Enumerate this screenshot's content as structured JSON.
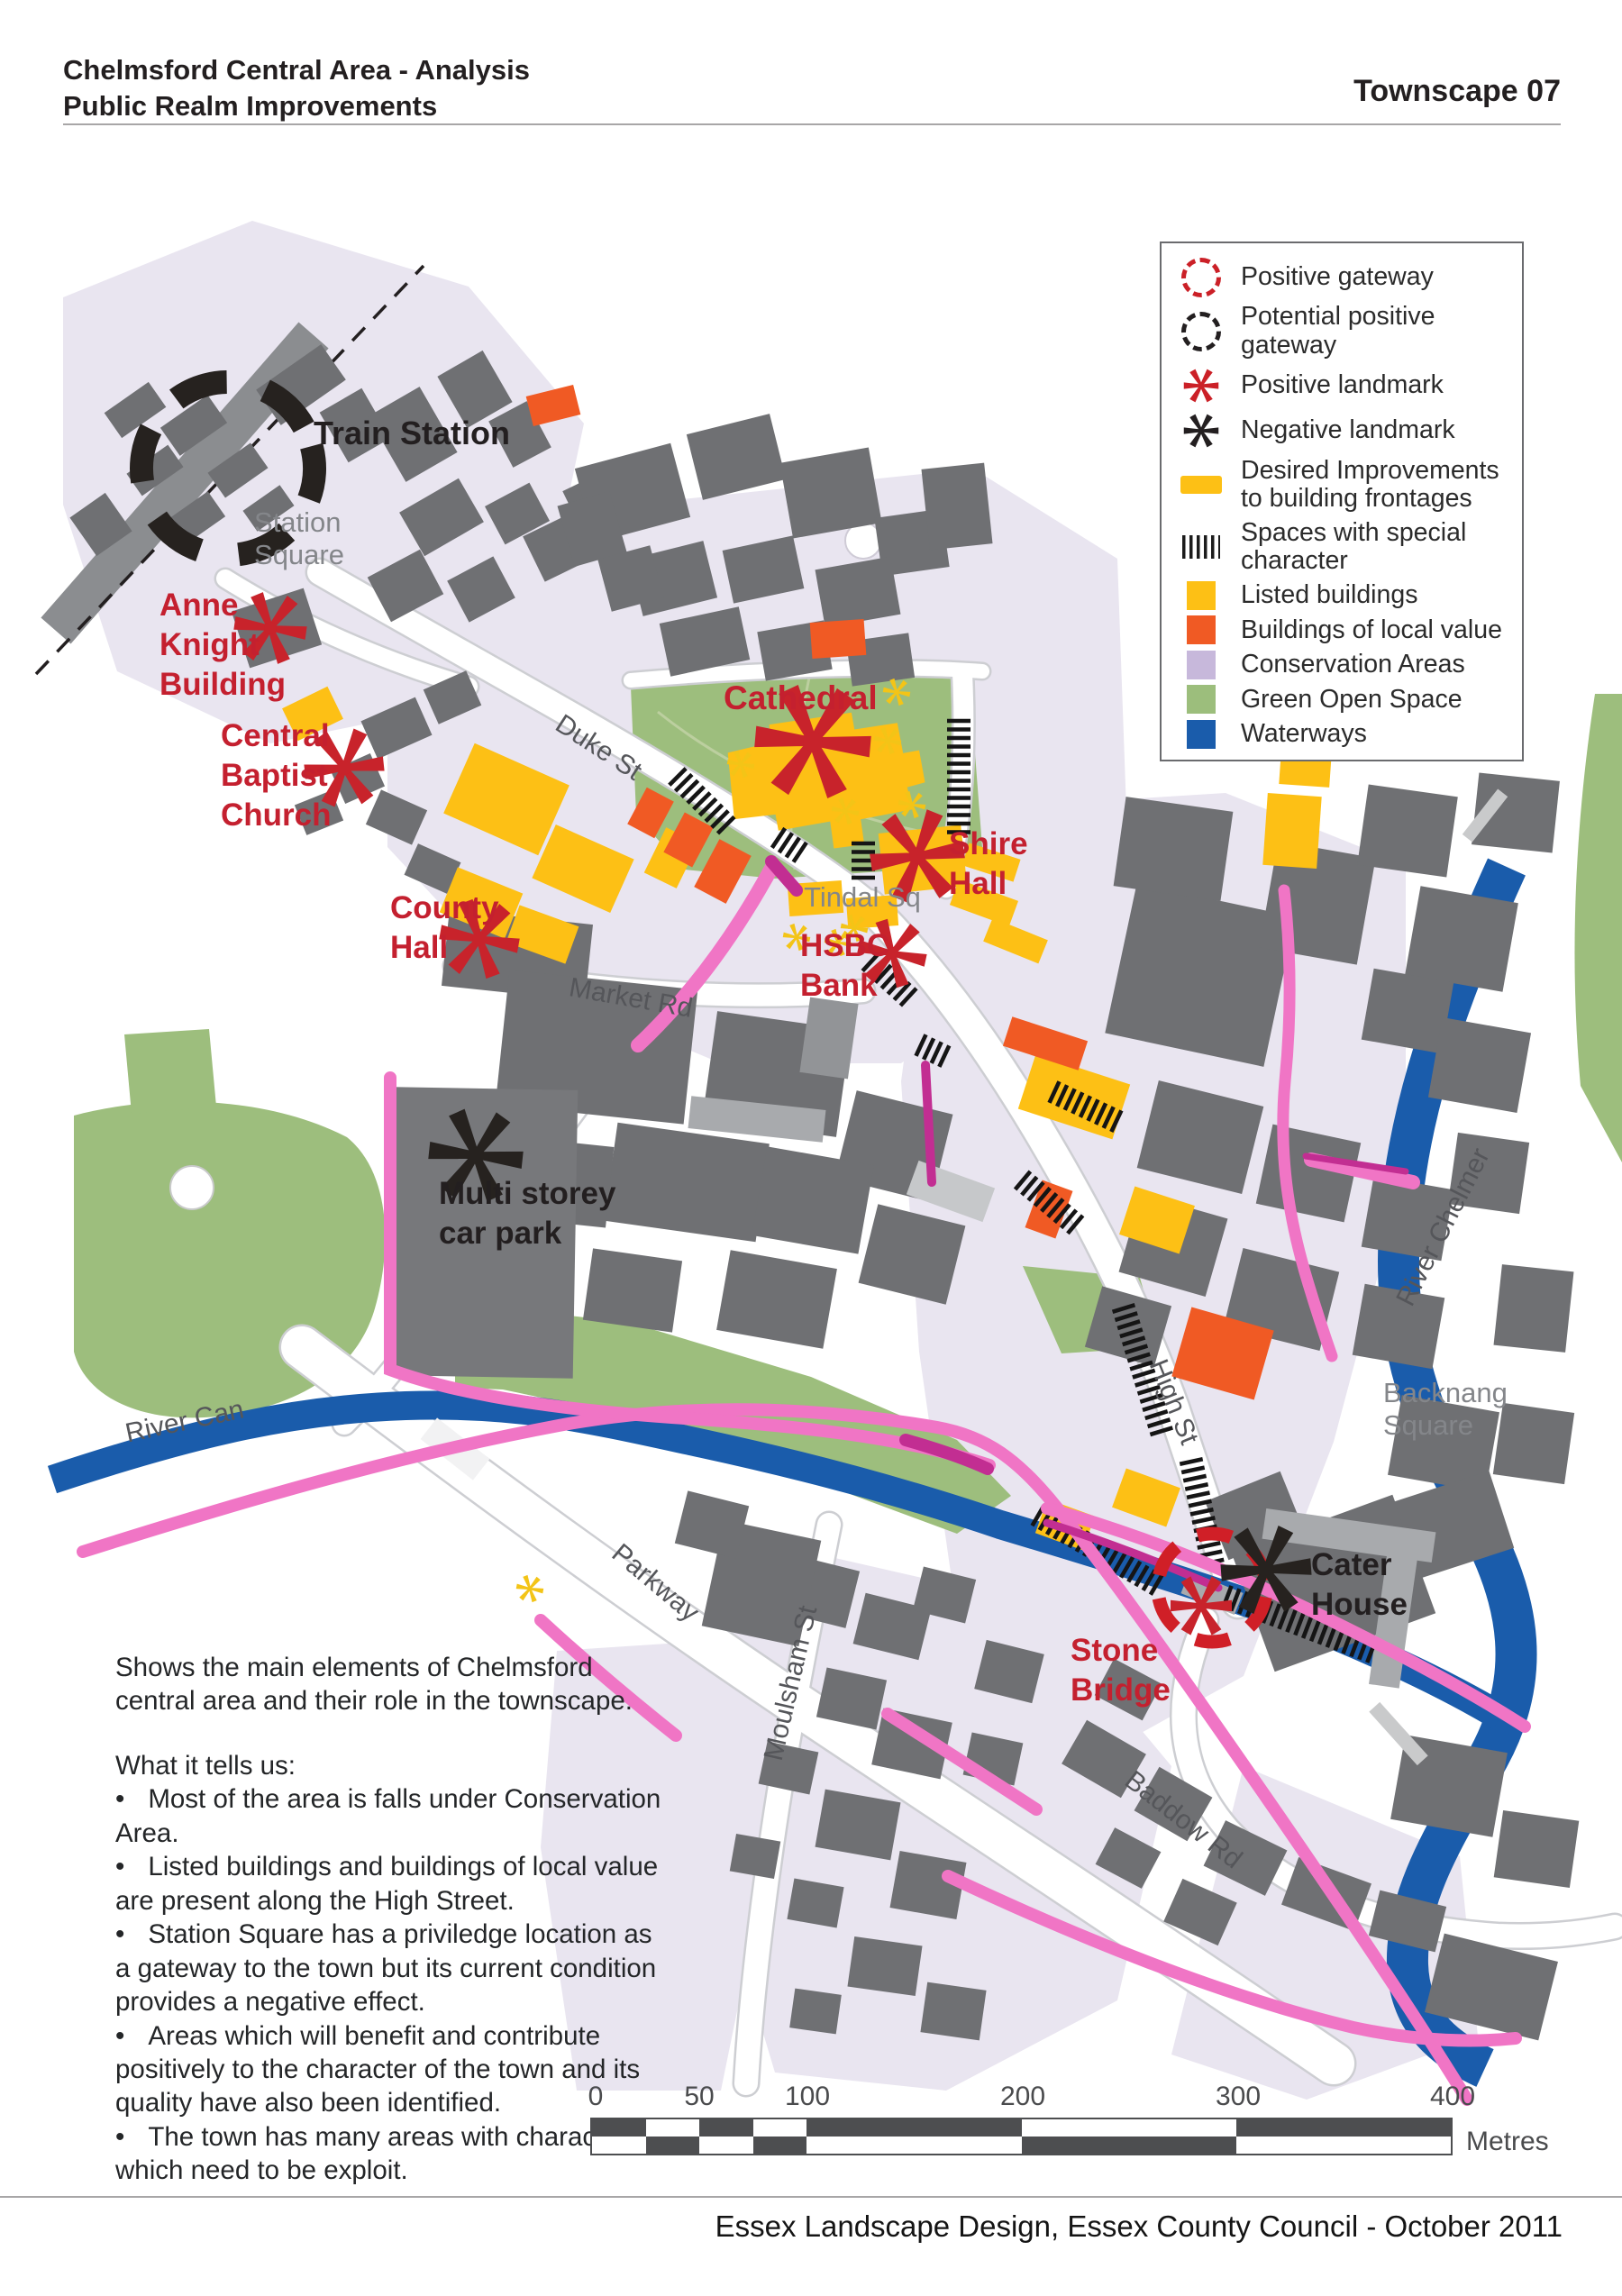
{
  "header": {
    "title_line1": "Chelmsford Central Area - Analysis",
    "title_line2": "Public Realm Improvements",
    "page_label": "Townscape",
    "page_number": "07"
  },
  "footer": {
    "credit": "Essex Landscape Design, Essex County Council - October 2011"
  },
  "legend": {
    "items": [
      {
        "id": "positive-gateway",
        "label": "Positive gateway",
        "color": "#CB2027"
      },
      {
        "id": "potential-positive-gateway",
        "label": "Potential positive gateway",
        "color": "#231F20"
      },
      {
        "id": "positive-landmark",
        "label": "Positive landmark",
        "color": "#CB2027"
      },
      {
        "id": "negative-landmark",
        "label": "Negative landmark",
        "color": "#231F20"
      },
      {
        "id": "desired-improvements",
        "label": "Desired Improvements to building frontages",
        "color": "#FDC015"
      },
      {
        "id": "special-character",
        "label": "Spaces with special character",
        "color": "#1C1C1C"
      },
      {
        "id": "listed-buildings",
        "label": "Listed buildings",
        "color": "#FDC015"
      },
      {
        "id": "local-value",
        "label": "Buildings of local value",
        "color": "#F05A24"
      },
      {
        "id": "conservation-areas",
        "label": "Conservation Areas",
        "color": "#C7B8DB"
      },
      {
        "id": "green-open-space",
        "label": "Green Open Space",
        "color": "#9CBE7C"
      },
      {
        "id": "waterways",
        "label": "Waterways",
        "color": "#1A5CAB"
      }
    ]
  },
  "map_labels": {
    "train_station": "Train Station",
    "station_square": "Station\nSquare",
    "anne_knight": "Anne\nKnight\nBuilding",
    "central_baptist": "Central\nBaptist\nChurch",
    "county_hall": "County\nHall",
    "cathedral": "Cathedral",
    "shire_hall": "Shire\nHall",
    "hsbc": "HSBC\nBank",
    "tindal_sq": "Tindal Sq",
    "multi_storey": "Multi storey\ncar park",
    "cater_house": "Cater\nHouse",
    "stone_bridge": "Stone\nBridge",
    "backnang": "Backnang\nSquare",
    "river_chelmer": "River Chelmer",
    "river_can": "River Can",
    "high_st": "High St",
    "duke_st": "Duke St",
    "market_rd": "Market Rd",
    "parkway": "Parkway",
    "baddow_rd": "Baddow Rd",
    "moulsham_st": "Moulsham St"
  },
  "notes": {
    "intro": "Shows the main elements of Chelmsford central area and their role in the townscape.",
    "heading": "What it tells us:",
    "bullets": [
      "Most of the area is falls under Conservation Area.",
      "Listed buildings and buildings of local value are present along the High Street.",
      "Station Square has a priviledge location as a gateway to the town but its current condition provides a negative effect.",
      "Areas which will benefit and contribute positively to the character of the town and its quality have also been identified.",
      "The town has many areas with character which need to be exploit."
    ]
  },
  "scale_bar": {
    "ticks": [
      "0",
      "50",
      "100",
      "200",
      "300",
      "400"
    ],
    "unit": "Metres"
  },
  "colors": {
    "building_gray": "#6F7073",
    "building_light": "#A8AAAD",
    "carpark_gray": "#77787B",
    "listed_yellow": "#FDC015",
    "local_value_orange": "#F05A24",
    "conservation_fill": "#E9E5F0",
    "legend_conservation": "#C7B8DB",
    "green_open": "#9DBE7D",
    "waterway_blue": "#1A5CAB",
    "frontage_pink": "#F075C5",
    "frontage_magenta": "#C22E92",
    "landmark_red": "#C8232B",
    "landmark_black": "#26221F",
    "mini_asterisk_yellow": "#F3C417",
    "railway_gray": "#8B8D90"
  }
}
